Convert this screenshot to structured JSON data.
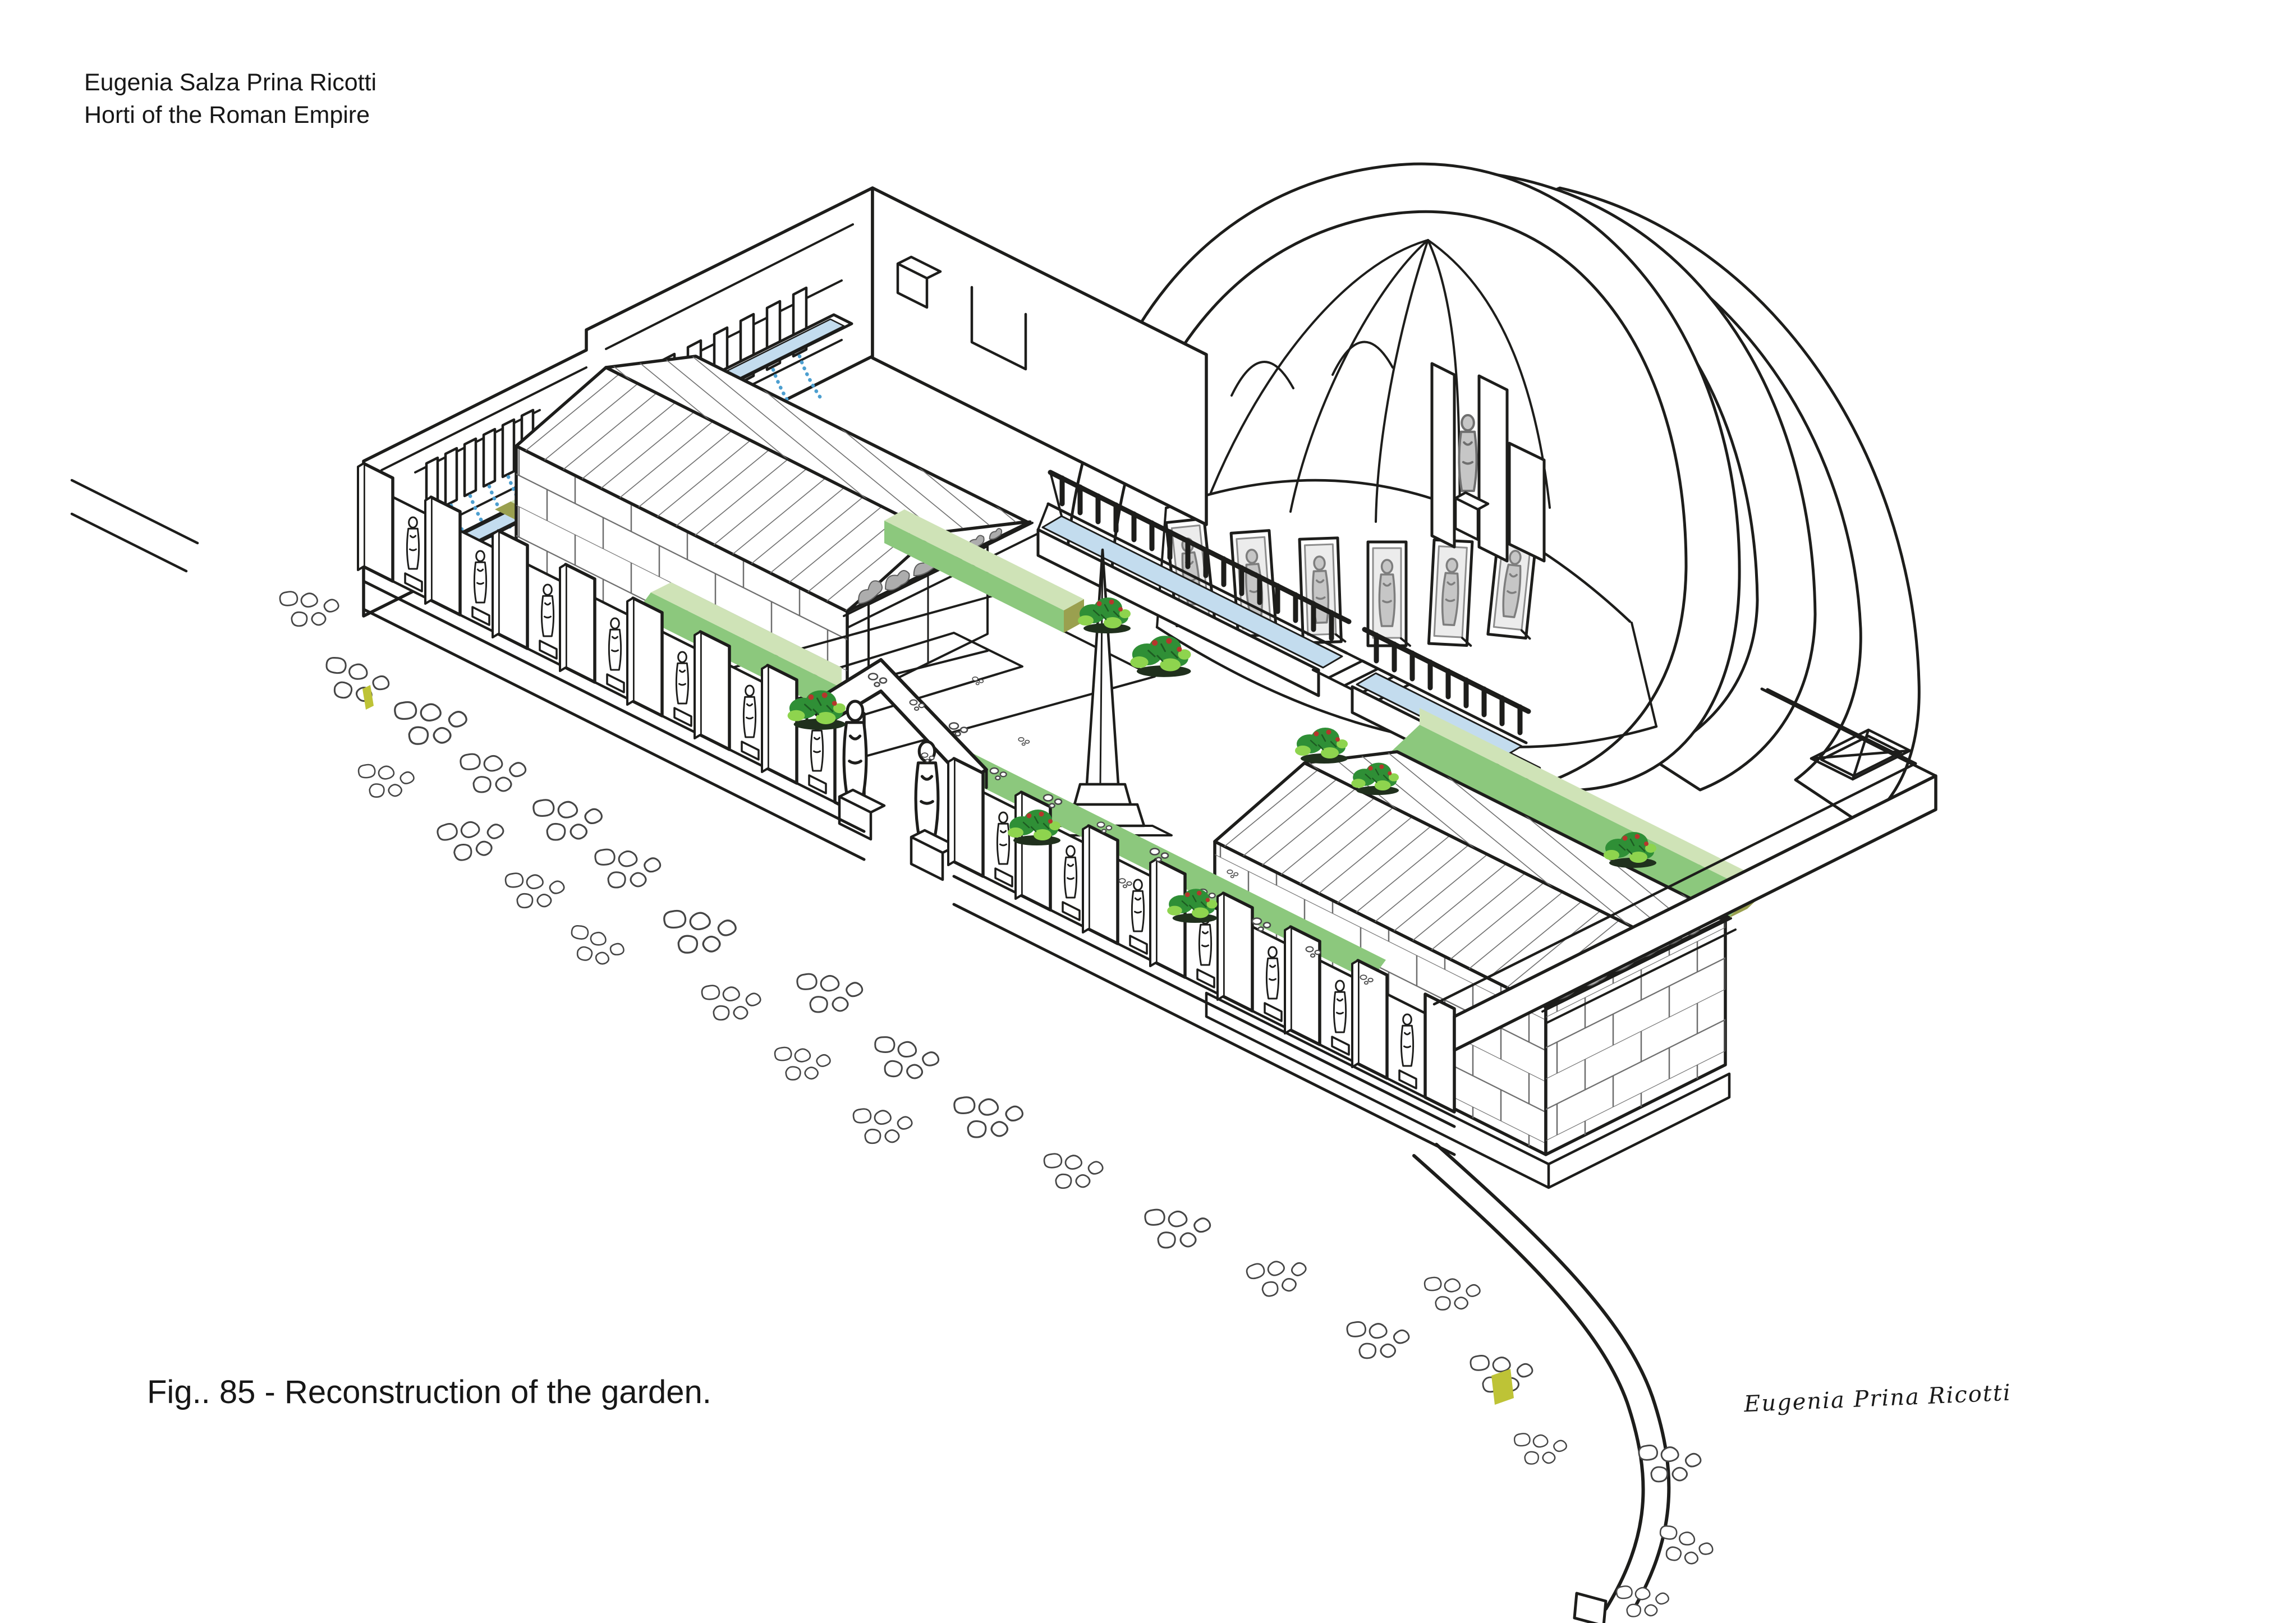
{
  "header": {
    "line1": "Eugenia Salza Prina Ricotti",
    "line2": "Horti of the Roman Empire"
  },
  "caption": {
    "text": "Fig.. 85 - Reconstruction of the garden."
  },
  "signature": {
    "text": "Eugenia Prina Ricotti"
  },
  "colors": {
    "ink": "#1d1d1b",
    "water": "#c3dcee",
    "water_jet": "#4d9fd0",
    "hedge_light": "#cfe3b7",
    "hedge_mid": "#8cc87d",
    "hedge_dark": "#9aa04f",
    "shrub_dark_green": "#2f8f36",
    "shrub_light_green": "#8ed44e",
    "shrub_flower_red": "#b5372c",
    "column_grey_top": "#8a8a8a",
    "column_grey_bottom": "#e0e0e0",
    "statue_grey": "#c6c6c6",
    "sculpture_grey": "#adadad",
    "marker_yellow": "#bec336",
    "background": "#ffffff"
  }
}
